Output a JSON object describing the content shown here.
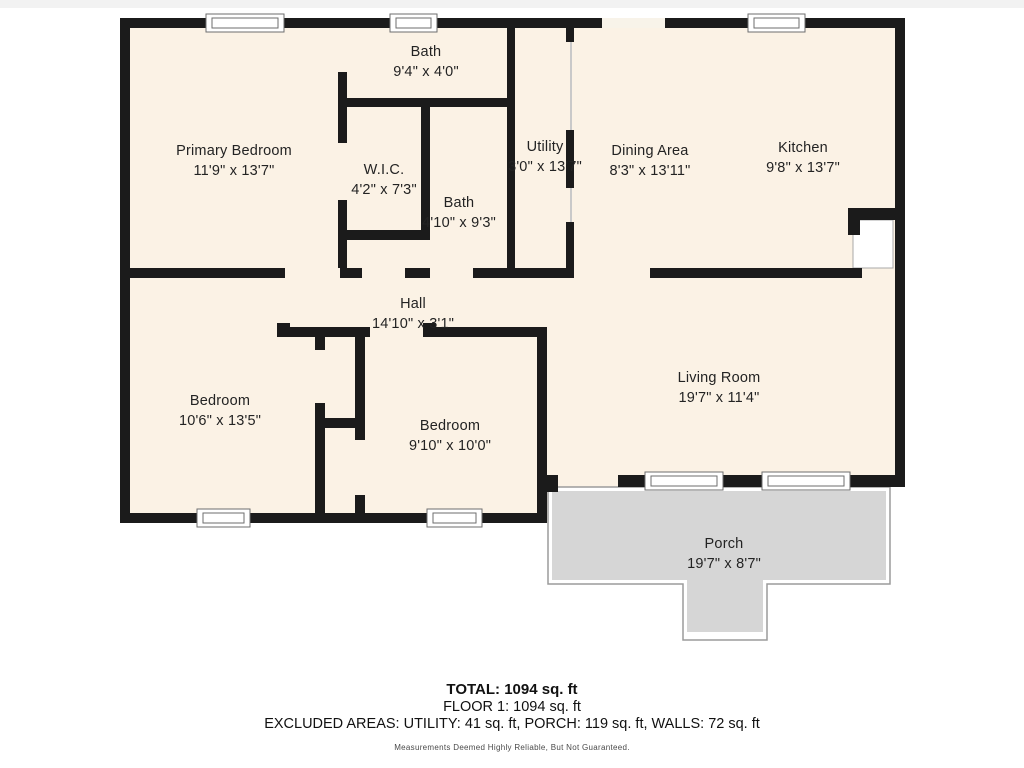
{
  "floorplan": {
    "rooms": [
      {
        "id": "primary-bedroom",
        "name": "Primary Bedroom",
        "dims": "11'9\" x 13'7\""
      },
      {
        "id": "bath-top",
        "name": "Bath",
        "dims": "9'4\" x 4'0\""
      },
      {
        "id": "wic",
        "name": "W.I.C.",
        "dims": "4'2\" x 7'3\""
      },
      {
        "id": "bath-hall",
        "name": "Bath",
        "dims": "4'10\" x 9'3\""
      },
      {
        "id": "utility",
        "name": "Utility",
        "dims": "3'0\" x 13'7\""
      },
      {
        "id": "dining-area",
        "name": "Dining Area",
        "dims": "8'3\" x 13'11\""
      },
      {
        "id": "kitchen",
        "name": "Kitchen",
        "dims": "9'8\" x 13'7\""
      },
      {
        "id": "hall",
        "name": "Hall",
        "dims": "14'10\" x 3'1\""
      },
      {
        "id": "bedroom-left",
        "name": "Bedroom",
        "dims": "10'6\" x 13'5\""
      },
      {
        "id": "bedroom-middle",
        "name": "Bedroom",
        "dims": "9'10\" x 10'0\""
      },
      {
        "id": "living-room",
        "name": "Living Room",
        "dims": "19'7\" x 11'4\""
      },
      {
        "id": "porch",
        "name": "Porch",
        "dims": "19'7\" x 8'7\""
      }
    ],
    "colors": {
      "wall": "#1b1b1b",
      "room_fill": "#fbf2e5",
      "porch_fill": "#d6d6d6",
      "porch_outline": "#9b9b9b"
    }
  },
  "summary": {
    "total": "TOTAL: 1094 sq. ft",
    "floor": "FLOOR 1: 1094 sq. ft",
    "excluded": "EXCLUDED AREAS: UTILITY: 41 sq. ft, PORCH: 119 sq. ft, WALLS: 72 sq. ft",
    "disclaimer": "Measurements Deemed Highly Reliable, But Not Guaranteed."
  }
}
